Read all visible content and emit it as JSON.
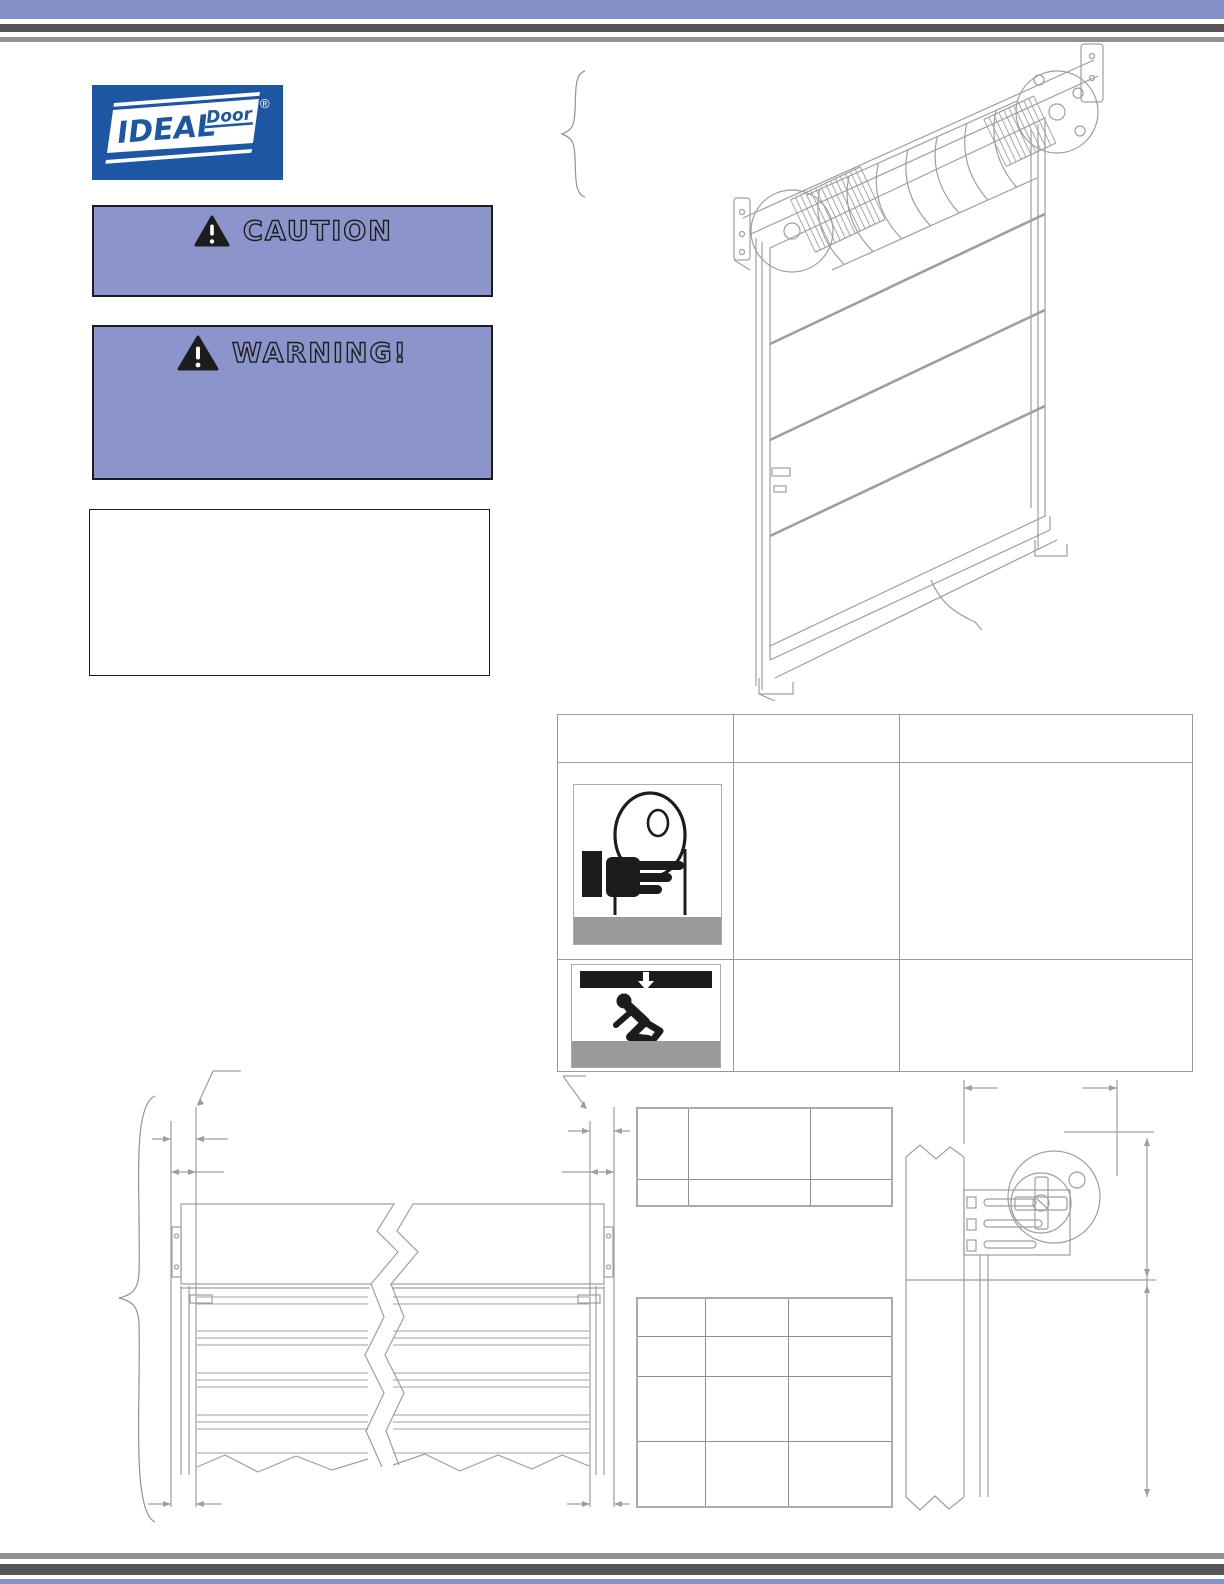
{
  "colors": {
    "bar_blue": "#8491c6",
    "bar_dark_gray": "#57545a",
    "bar_light_gray": "#949095",
    "alert_panel_blue": "#8b95cb",
    "logo_blue": "#1d57a4",
    "line_art_gray": "#9aa0a2",
    "hazard_black": "#1c1c1c",
    "icon_caption_gray": "#9a9a9a"
  },
  "logo": {
    "brand": "IDEAL",
    "product": "Door",
    "registered_mark": "®"
  },
  "alerts": {
    "caution": {
      "title": "CAUTION",
      "body": ""
    },
    "warning": {
      "title": "WARNING!",
      "body": ""
    }
  },
  "notice_box": {
    "content": ""
  },
  "figures": {
    "door_isometric": "rolling-steel-door-isometric-view",
    "front_elevation": "door-front-elevation-with-break-lines",
    "bracket_detail": "spring-tension-bracket-side-view"
  },
  "hazard_table": {
    "header": [
      "",
      "",
      ""
    ],
    "rows": [
      {
        "icon": "spring-pinch-hazard-icon",
        "caption": "",
        "cells": [
          "",
          ""
        ]
      },
      {
        "icon": "door-crush-hazard-icon",
        "caption": "",
        "cells": [
          "",
          ""
        ]
      }
    ]
  },
  "spec_table_small": {
    "cells": [
      [
        "",
        "",
        ""
      ],
      [
        "",
        "",
        ""
      ]
    ]
  },
  "spec_table_large": {
    "cells": [
      [
        "",
        "",
        ""
      ],
      [
        "",
        "",
        ""
      ],
      [
        "",
        "",
        ""
      ],
      [
        "",
        "",
        ""
      ]
    ]
  }
}
